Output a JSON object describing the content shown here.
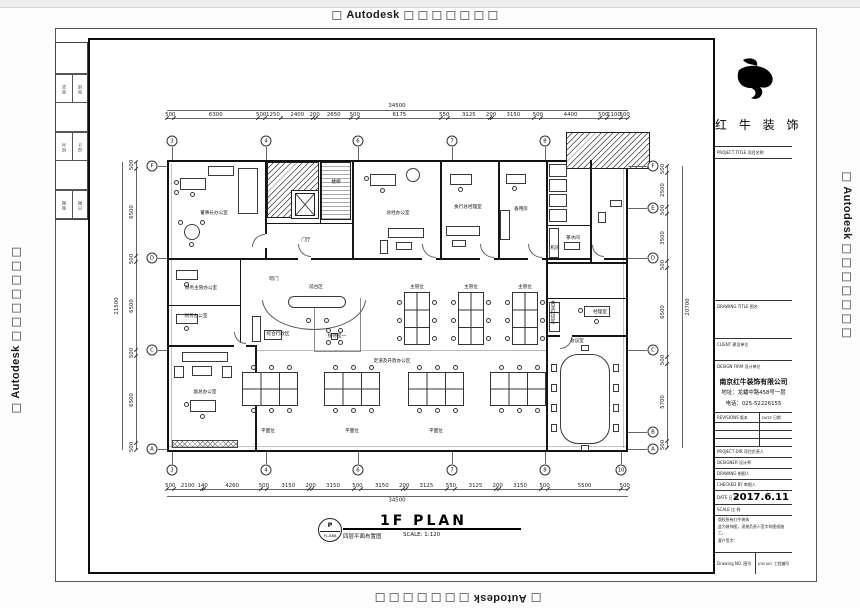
{
  "page": {
    "watermark_text": "Autodesk"
  },
  "edge_strip": {
    "rows": [
      [
        "审定",
        "审核"
      ],
      [
        "校对",
        "设计"
      ],
      [
        "制图",
        "日期"
      ]
    ]
  },
  "title_block": {
    "brand": "红 牛 装 饰",
    "project_title_label": "PROJECT TITLE 项目名称",
    "drawing_title_label": "DRAWING TITLE 图名",
    "client_label": "CLIENT 建设单位",
    "design_firm_label": "DESIGN FIRM 设计单位",
    "company": "南京红牛装饰有限公司",
    "address": "地址：龙蟠中路458号一层",
    "phone": "电话：025-52226155",
    "revisions_label": "REVISIONS 版本",
    "rev_date_label": "DATE 日期",
    "project_dir_label": "PROJECT DIR 项目负责人",
    "designer_label": "DESIGNER 设计师",
    "drawing_label": "DRAWING 制图人",
    "checked_label": "CHECKED BY 审图人",
    "date_label": "DATE 日 期",
    "date_value": "2017.6.11",
    "scale_label": "SCALE 比 例",
    "note1": "版权所有红牛装饰",
    "note2": "此为装饰图，须按负责人签字的图纸施工。",
    "sign_label": "客户签字：",
    "drawing_no_label": "Drawing NO. 图号",
    "job_no_label": "JOB NO. 工程编号"
  },
  "plan": {
    "title": "1F PLAN",
    "subtitle": "四层平面布置图",
    "scale": "SCALE: 1:120",
    "stamp_top": "P",
    "stamp_bottom": "FL-888",
    "grid": {
      "top": [
        "3",
        "4",
        "6",
        "7",
        "8"
      ],
      "bottom": [
        "3",
        "4",
        "6",
        "7",
        "8",
        "10"
      ],
      "left": [
        "F",
        "D",
        "C",
        "A"
      ],
      "right": [
        "F",
        "E",
        "D",
        "C",
        "B",
        "A"
      ]
    },
    "dims": {
      "top": {
        "total": "34500",
        "segments": [
          "500",
          "6300",
          "500",
          "1250",
          "2400",
          "200",
          "2650",
          "500",
          "6175",
          "550",
          "3125",
          "200",
          "3150",
          "500",
          "4400",
          "500",
          "1100",
          "500"
        ]
      },
      "bottom": {
        "total": "34500",
        "segments": [
          "500",
          "2100",
          "140",
          "4260",
          "500",
          "3150",
          "200",
          "3150",
          "500",
          "3150",
          "200",
          "3125",
          "550",
          "3125",
          "200",
          "3150",
          "500",
          "5500",
          "500"
        ]
      },
      "left": {
        "total": "21500",
        "segments": [
          "500",
          "6500",
          "500",
          "6500",
          "500",
          "6500",
          "500"
        ]
      },
      "right": {
        "total": "20700",
        "segments": [
          "500",
          "2500",
          "500",
          "3500",
          "500",
          "6500",
          "500",
          "5700",
          "500"
        ]
      }
    },
    "rooms": [
      {
        "label": "董事长办公室",
        "x": 214,
        "y": 213
      },
      {
        "label": "楼梯",
        "x": 336,
        "y": 182
      },
      {
        "label": "门厅",
        "x": 306,
        "y": 240
      },
      {
        "label": "总经办公室",
        "x": 398,
        "y": 213
      },
      {
        "label": "执行总经理室",
        "x": 468,
        "y": 207
      },
      {
        "label": "备用房",
        "x": 521,
        "y": 209
      },
      {
        "label": "茶水间",
        "x": 573,
        "y": 238
      },
      {
        "label": "机房",
        "x": 555,
        "y": 248
      },
      {
        "label": "暗门",
        "x": 274,
        "y": 279
      },
      {
        "label": "前台区",
        "x": 316,
        "y": 287
      },
      {
        "label": "综合行政区",
        "x": 278,
        "y": 334
      },
      {
        "label": "接待室一",
        "x": 337,
        "y": 336
      },
      {
        "label": "走道及开放办公区",
        "x": 392,
        "y": 361
      },
      {
        "label": "主管位",
        "x": 417,
        "y": 287
      },
      {
        "label": "主管位",
        "x": 471,
        "y": 287
      },
      {
        "label": "主管位",
        "x": 525,
        "y": 287
      },
      {
        "label": "财务主管办公室",
        "x": 201,
        "y": 288
      },
      {
        "label": "财务办公室",
        "x": 196,
        "y": 316
      },
      {
        "label": "副总办公室",
        "x": 205,
        "y": 392
      },
      {
        "label": "会议室",
        "x": 577,
        "y": 341
      },
      {
        "label": "经理室",
        "x": 600,
        "y": 312
      },
      {
        "label": "共享打印区",
        "x": 552,
        "y": 312,
        "v": true
      },
      {
        "label": "平面位",
        "x": 268,
        "y": 431
      },
      {
        "label": "平面位",
        "x": 352,
        "y": 431
      },
      {
        "label": "平面位",
        "x": 436,
        "y": 431
      }
    ]
  }
}
